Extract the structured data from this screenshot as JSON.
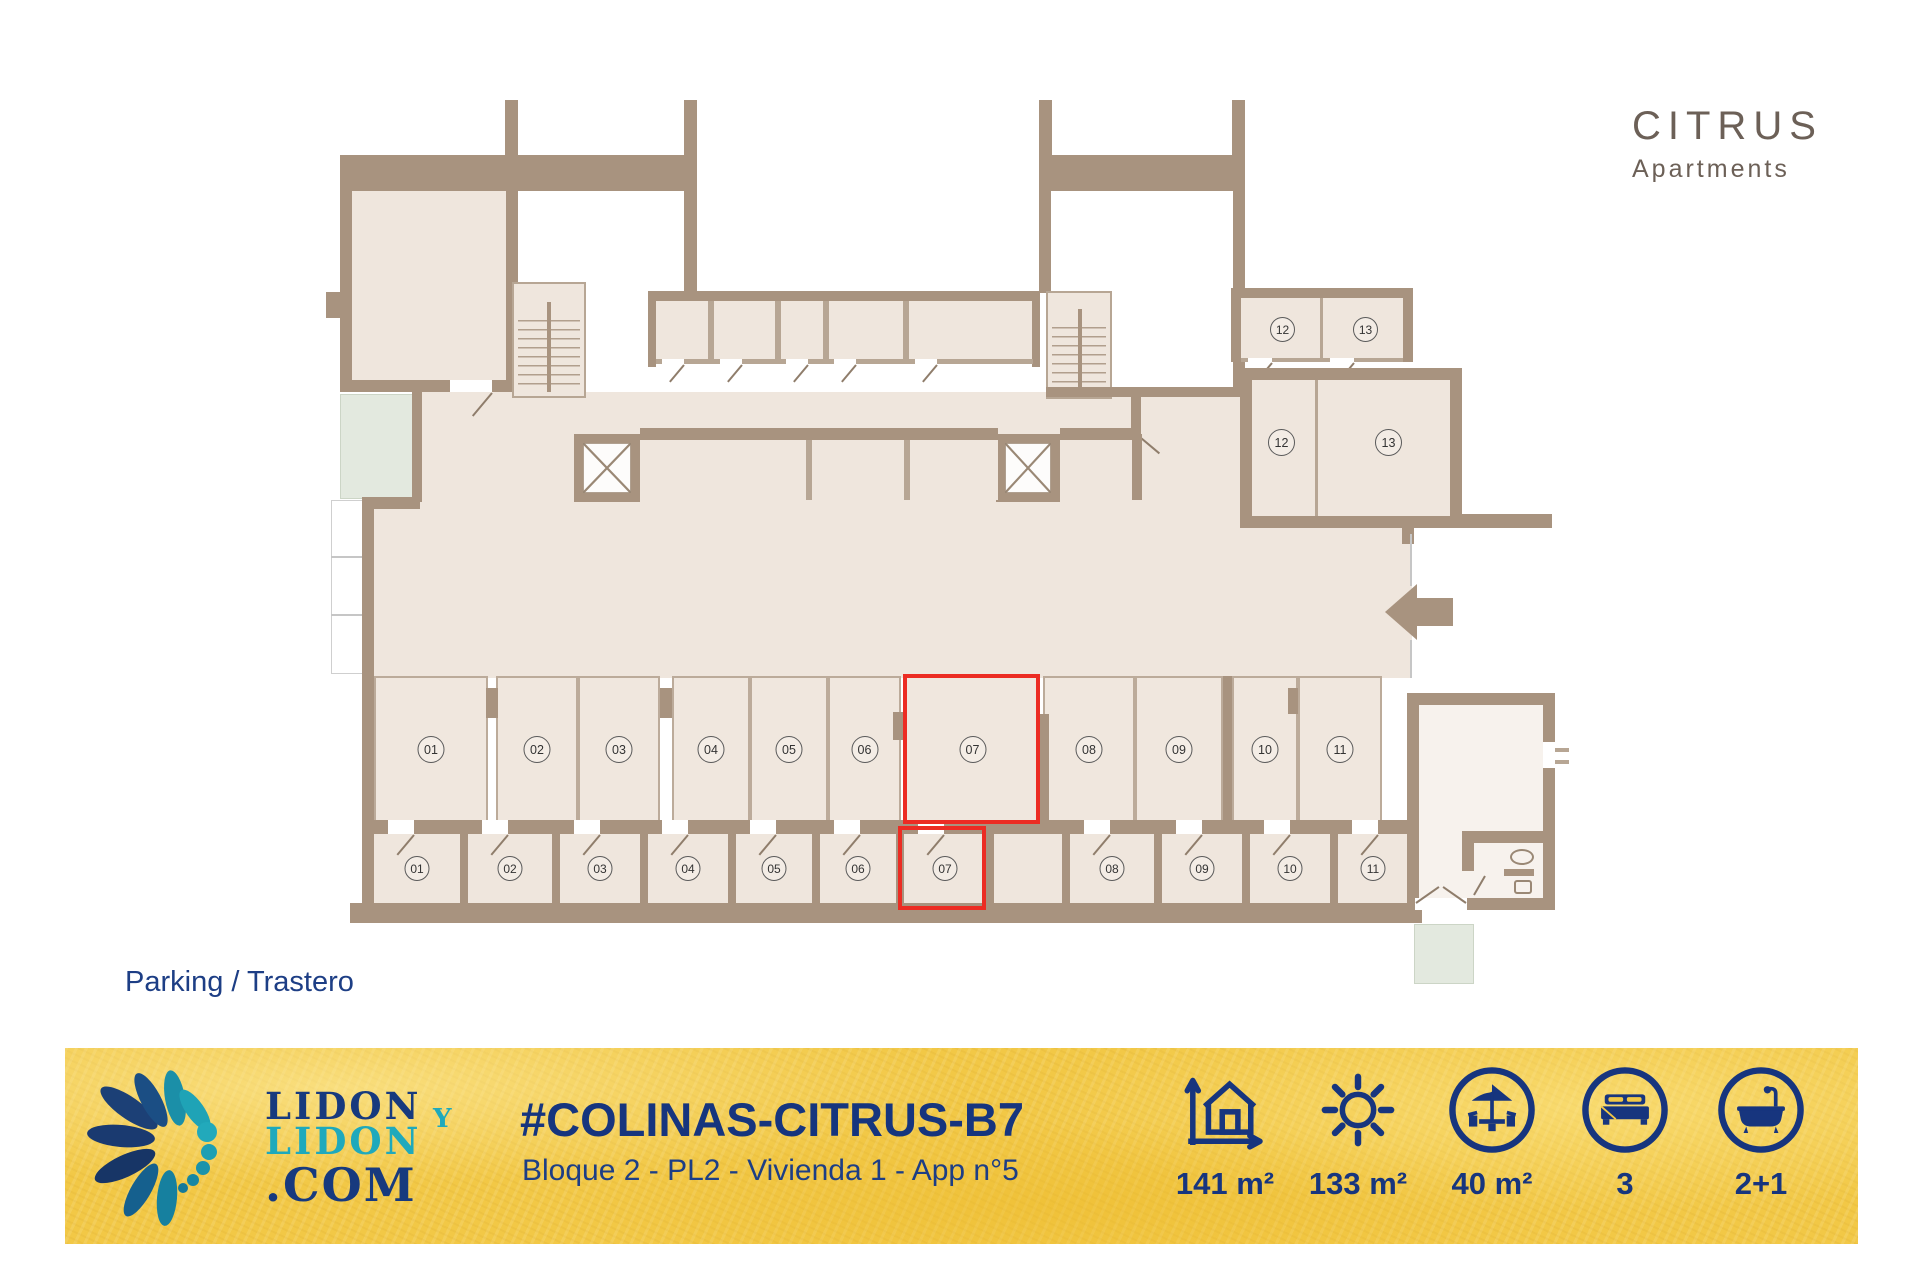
{
  "brand": {
    "name": "CITRUS",
    "tagline": "Apartments"
  },
  "plan": {
    "floor_label": "Parking / Trastero",
    "highlighted_spot": "07",
    "highlight_color": "#EC2C23",
    "parking_spots": [
      {
        "label": "01"
      },
      {
        "label": "02"
      },
      {
        "label": "03"
      },
      {
        "label": "04"
      },
      {
        "label": "05"
      },
      {
        "label": "06"
      },
      {
        "label": "07",
        "highlighted": true
      },
      {
        "label": "08"
      },
      {
        "label": "09"
      },
      {
        "label": "10"
      },
      {
        "label": "11"
      }
    ],
    "trasteros": [
      {
        "label": "01"
      },
      {
        "label": "02"
      },
      {
        "label": "03"
      },
      {
        "label": "04"
      },
      {
        "label": "05"
      },
      {
        "label": "06"
      },
      {
        "label": "07",
        "highlighted": true
      },
      {
        "label": "08"
      },
      {
        "label": "09"
      },
      {
        "label": "10"
      },
      {
        "label": "11"
      }
    ],
    "upper_small": [
      {
        "label": "12"
      },
      {
        "label": "13"
      }
    ],
    "upper_large": [
      {
        "label": "12"
      },
      {
        "label": "13"
      }
    ]
  },
  "footer": {
    "logo": {
      "line1": "LIDON",
      "connector": "Y",
      "line2": "LIDON",
      "line3": ".COM"
    },
    "listing_code": "#COLINAS-CITRUS-B7",
    "listing_details": "Bloque 2 - PL2 - Vivienda 1 - App n°5",
    "stats": [
      {
        "icon": "floor-area-icon",
        "value": "141 m²"
      },
      {
        "icon": "sun-terrace-icon",
        "value": "133 m²"
      },
      {
        "icon": "covered-terrace-icon",
        "value": "40 m²"
      },
      {
        "icon": "bedrooms-icon",
        "value": "3"
      },
      {
        "icon": "bathrooms-icon",
        "value": "2+1"
      }
    ]
  },
  "colors": {
    "banner_yellow": "#F2C846",
    "navy": "#17357E",
    "teal": "#1FA9BC",
    "wall": "#A8937F",
    "floor": "#EFE6DD",
    "highlight_red": "#EC2C23"
  }
}
